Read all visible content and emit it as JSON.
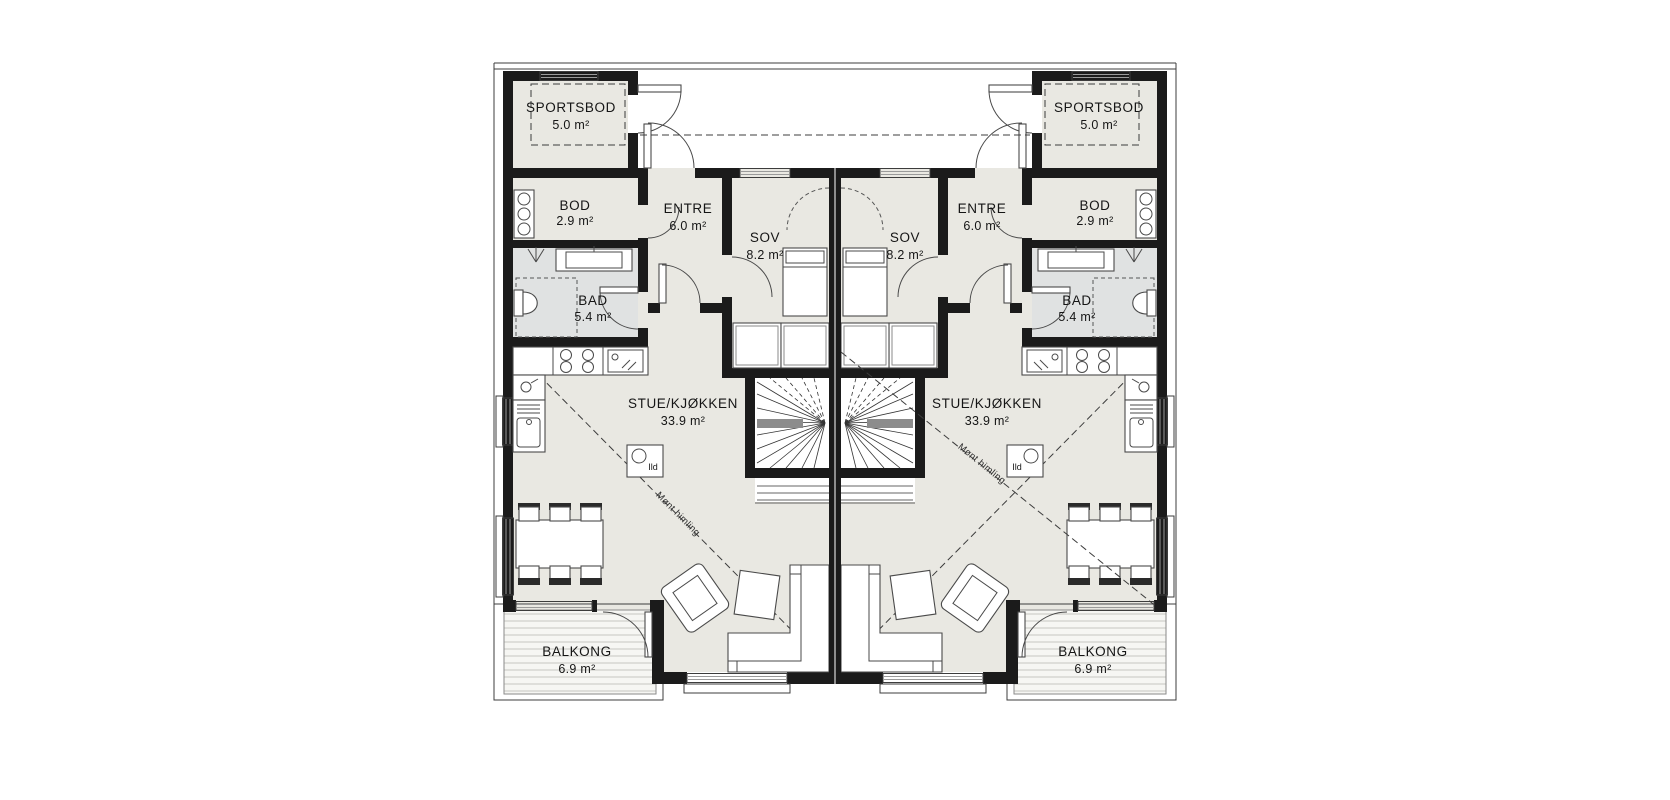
{
  "document": {
    "type": "architectural-floor-plan",
    "background": "#ffffff"
  },
  "colors": {
    "wall": "#1b1b1b",
    "room_fill": "#e9e8e2",
    "bathroom_fill": "#e0e2e2",
    "balcony_deck": "#f6f6f3",
    "deck_line": "#c6c6c0",
    "stair_landing": "#8c8c8c",
    "text": "#151515"
  },
  "units": [
    "left",
    "right"
  ],
  "rooms": {
    "sportsbod": {
      "name": "SPORTSBOD",
      "area": "5.0 m²"
    },
    "bod": {
      "name": "BOD",
      "area": "2.9 m²"
    },
    "entre": {
      "name": "ENTRE",
      "area": "6.0 m²"
    },
    "sov": {
      "name": "SOV",
      "area": "8.2 m²"
    },
    "bad": {
      "name": "BAD",
      "area": "5.4 m²"
    },
    "stue_kjokken": {
      "name": "STUE/KJØKKEN",
      "area": "33.9 m²"
    },
    "balkong": {
      "name": "BALKONG",
      "area": "6.9 m²"
    }
  },
  "annotations": {
    "ceiling": "Mønt himling",
    "fireplace": "Ild"
  },
  "fixtures": [
    "stairs-icon",
    "bed-icon",
    "wardrobe-icon",
    "washer-icon",
    "toilet-icon",
    "shower-icon",
    "vanity-icon",
    "sink-icon",
    "cooktop-icon",
    "cutting-board-icon",
    "fireplace-icon",
    "dining-table-icon",
    "chair-icon",
    "armchair-icon",
    "coffee-table-icon",
    "sofa-icon",
    "door-swing-icon",
    "window-icon"
  ]
}
